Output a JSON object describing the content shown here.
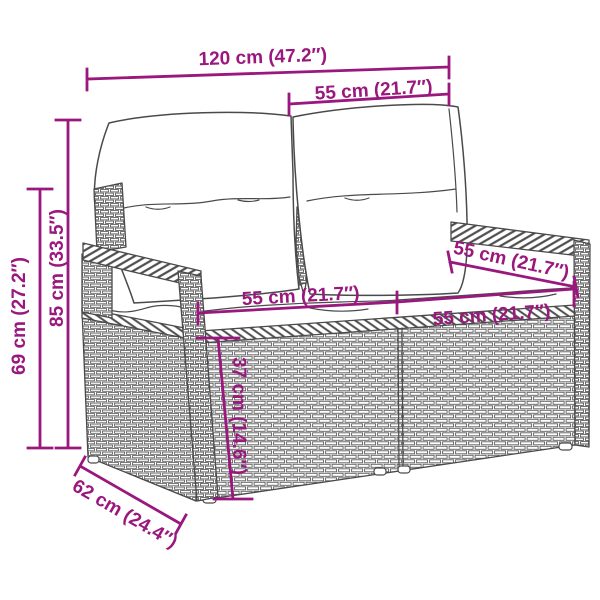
{
  "diagram": {
    "type": "furniture-dimension-diagram",
    "subject": "poly rattan garden loveseat with back and seat cushions",
    "background_color": "#ffffff",
    "accent_color": "#9a177d",
    "line_art_color": "#4a4a4a",
    "units": [
      "cm",
      "inches"
    ],
    "dimensions": [
      {
        "id": "overall-width",
        "label": "120 cm (47.2″)",
        "value_cm": 120,
        "value_in": 47.2
      },
      {
        "id": "backrest-width",
        "label": "55 cm (21.7″)",
        "value_cm": 55,
        "value_in": 21.7
      },
      {
        "id": "overall-height",
        "label": "85 cm (33.5″)",
        "value_cm": 85,
        "value_in": 33.5
      },
      {
        "id": "armrest-height",
        "label": "69 cm (27.2″)",
        "value_cm": 69,
        "value_in": 27.2
      },
      {
        "id": "seat-width-left",
        "label": "55 cm (21.7″)",
        "value_cm": 55,
        "value_in": 21.7
      },
      {
        "id": "seat-width-right",
        "label": "55 cm (21.7″)",
        "value_cm": 55,
        "value_in": 21.7
      },
      {
        "id": "seat-depth",
        "label": "55 cm (21.7″)",
        "value_cm": 55,
        "value_in": 21.7
      },
      {
        "id": "seat-height",
        "label": "37 cm (14.6″)",
        "value_cm": 37,
        "value_in": 14.6
      },
      {
        "id": "base-depth",
        "label": "62 cm (24.4″)",
        "value_cm": 62,
        "value_in": 24.4
      }
    ]
  }
}
